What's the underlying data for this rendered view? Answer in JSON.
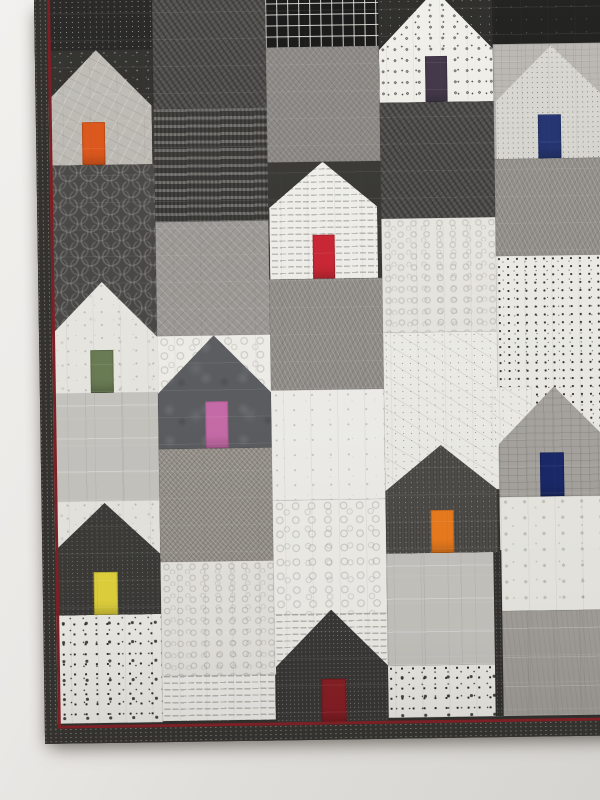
{
  "scene": {
    "subject": "modern patchwork quilt wall hanging, house blocks in black, white and gray prints, each house with a single brightly colored door",
    "setting": "quilt hangs slightly tilted on a plain light wall; wall visible along left edge and below the quilt",
    "house_count_visible": 10
  },
  "wall": {
    "color_top_left": "#f1f0ed",
    "color_bottom_right": "#d6d4d0"
  },
  "quilt": {
    "motif": "pieced houses",
    "palette": "black / white / gray prints with accent doors",
    "binding_color": "#33322e",
    "piping_color": "#7c2026",
    "quilting": "straight-line crosshatch grid"
  },
  "houses": [
    {
      "id": "upper-left",
      "body_fabric": "light gray sketch print",
      "door_color": "orange",
      "door_hex": "#dd5214"
    },
    {
      "id": "top-center",
      "body_fabric": "white with black flower dots",
      "door_color": "dark purple",
      "door_hex": "#3b3042"
    },
    {
      "id": "top-right",
      "body_fabric": "light gray pin-dot",
      "door_color": "navy blue",
      "door_hex": "#1e2e6e"
    },
    {
      "id": "center-upper",
      "body_fabric": "white text print",
      "door_color": "red",
      "door_hex": "#cb2230"
    },
    {
      "id": "middle-left",
      "body_fabric": "white speckle print",
      "door_color": "moss green",
      "door_hex": "#697c52"
    },
    {
      "id": "center",
      "body_fabric": "charcoal batik",
      "door_color": "orchid pink",
      "door_hex": "#ca6cab"
    },
    {
      "id": "middle-right",
      "body_fabric": "gray crosshatch weave",
      "door_color": "navy blue",
      "door_hex": "#19276a"
    },
    {
      "id": "lower-center",
      "body_fabric": "dark gray speckle",
      "door_color": "bright orange",
      "door_hex": "#ef7d1d"
    },
    {
      "id": "lower-left",
      "body_fabric": "charcoal fleck",
      "door_color": "yellow",
      "door_hex": "#e6d63e"
    },
    {
      "id": "bottom-center",
      "body_fabric": "black heather speckle",
      "door_color": "dark maroon",
      "door_hex": "#8a2026"
    }
  ]
}
